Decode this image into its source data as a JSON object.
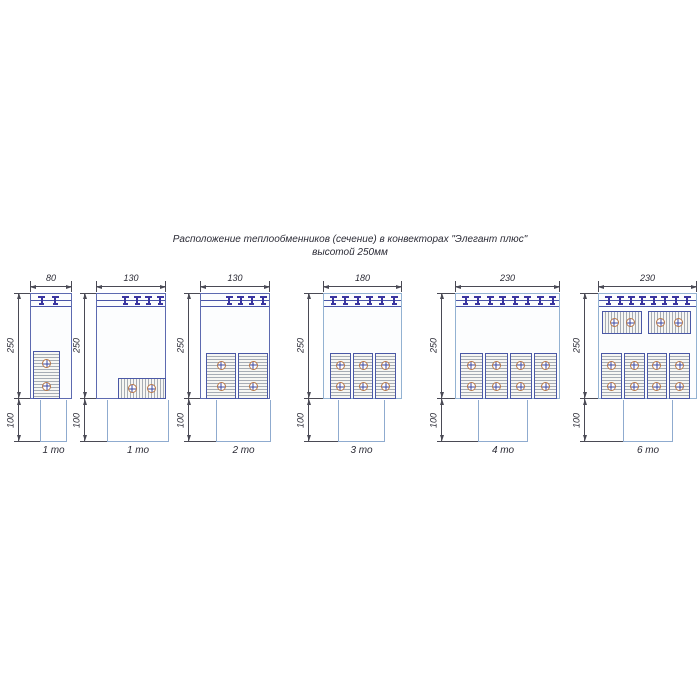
{
  "title": {
    "line1": "Расположение теплообменников (сечение) в конвекторах \"Элегант плюс\"",
    "line2": "высотой 250мм"
  },
  "palette": {
    "casing_dark": "#5d6ab0",
    "casing_light": "#93b2d2",
    "band": "#4a55a8",
    "clip": "#3a35a0",
    "exchanger_border": "#4a58a6",
    "hatch_line": "#a6acb4",
    "hatch_bg": "#f6f6f3",
    "pipe_ring": "#b5774a",
    "pipe_cross": "#3c48a0",
    "duct": "#8fabcf",
    "dimension": "#4a4a55",
    "text": "#2a2a35"
  },
  "diagrams": [
    {
      "caption": "1 то",
      "width_label": "80",
      "height_label": "250",
      "lower_label": "100",
      "exchanger_count": 1,
      "layout": {
        "box_x": 30,
        "box_w": 42,
        "duct_x": 40,
        "duct_w": 27,
        "dim_x": 18,
        "casing": "dark",
        "clips": 2,
        "clip_f0": 0.28,
        "clip_f1": 0.6,
        "vgroup": {
          "x": 33,
          "y": 351,
          "w": 27,
          "h": 48,
          "count": 1
        },
        "hgroups": []
      }
    },
    {
      "caption": "1 то",
      "width_label": "130",
      "height_label": "250",
      "lower_label": "100",
      "exchanger_count": 1,
      "layout": {
        "box_x": 96,
        "box_w": 70,
        "duct_x": 107,
        "duct_w": 62,
        "dim_x": 84,
        "casing": "dark",
        "clips": 4,
        "clip_f0": 0.42,
        "clip_f1": 0.92,
        "vgroup": null,
        "hgroups": [
          {
            "x": 118,
            "y": 378,
            "w": 48,
            "h": 21
          }
        ]
      }
    },
    {
      "caption": "2 то",
      "width_label": "130",
      "height_label": "250",
      "lower_label": "100",
      "exchanger_count": 2,
      "layout": {
        "box_x": 200,
        "box_w": 70,
        "duct_x": 216,
        "duct_w": 55,
        "dim_x": 188,
        "casing": "dark",
        "clips": 4,
        "clip_f0": 0.42,
        "clip_f1": 0.9,
        "vgroup": {
          "x": 206,
          "y": 353,
          "w": 62,
          "h": 46,
          "count": 2
        },
        "hgroups": []
      }
    },
    {
      "caption": "3 то",
      "width_label": "180",
      "height_label": "250",
      "lower_label": "100",
      "exchanger_count": 3,
      "layout": {
        "box_x": 323,
        "box_w": 79,
        "duct_x": 338,
        "duct_w": 47,
        "dim_x": 308,
        "casing": "light",
        "clips": 6,
        "clip_f0": 0.13,
        "clip_f1": 0.9,
        "vgroup": {
          "x": 330,
          "y": 353,
          "w": 66,
          "h": 46,
          "count": 3
        },
        "hgroups": []
      }
    },
    {
      "caption": "4 то",
      "width_label": "230",
      "height_label": "250",
      "lower_label": "100",
      "exchanger_count": 4,
      "layout": {
        "box_x": 455,
        "box_w": 105,
        "duct_x": 478,
        "duct_w": 50,
        "dim_x": 441,
        "casing": "light",
        "clips": 8,
        "clip_f0": 0.1,
        "clip_f1": 0.93,
        "vgroup": {
          "x": 460,
          "y": 353,
          "w": 97,
          "h": 46,
          "count": 4
        },
        "hgroups": []
      }
    },
    {
      "caption": "6 то",
      "width_label": "230",
      "height_label": "250",
      "lower_label": "100",
      "exchanger_count": 6,
      "layout": {
        "box_x": 598,
        "box_w": 99,
        "duct_x": 623,
        "duct_w": 50,
        "dim_x": 584,
        "casing": "light",
        "clips": 8,
        "clip_f0": 0.11,
        "clip_f1": 0.9,
        "vgroup": {
          "x": 601,
          "y": 353,
          "w": 89,
          "h": 46,
          "count": 4
        },
        "hgroups": [
          {
            "x": 602,
            "y": 311,
            "w": 40,
            "h": 23
          },
          {
            "x": 648,
            "y": 311,
            "w": 43,
            "h": 23
          }
        ]
      }
    }
  ],
  "geometry": {
    "box_y": 293,
    "box_h": 106,
    "duct_y": 399,
    "duct_h": 43,
    "band_y1": 300,
    "band_y2": 306,
    "top_dim_y": 286,
    "caption_y": 445
  }
}
